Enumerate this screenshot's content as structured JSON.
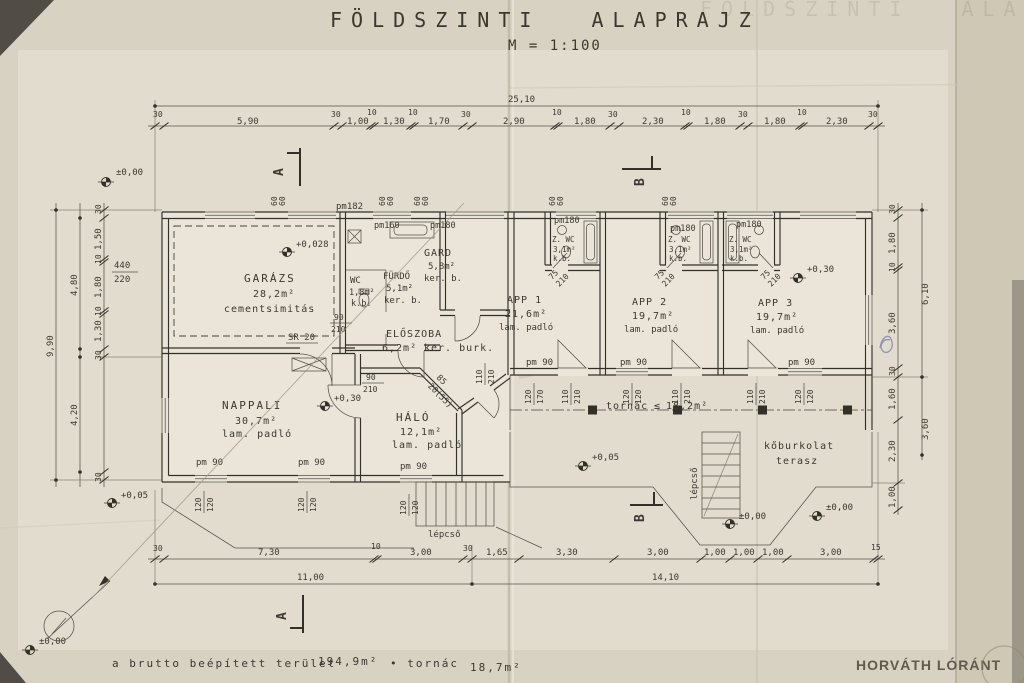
{
  "title": {
    "main": "FÖLDSZINTI ALAPRAJZ",
    "scale": "M = 1:100"
  },
  "sections": {
    "a": "A",
    "b": "B"
  },
  "rooms": {
    "garazs": {
      "name": "GARÁZS",
      "area": "28,2m²",
      "finish": "cementsimitás"
    },
    "nappali": {
      "name": "NAPPALI",
      "area": "30,7m²",
      "finish": "lam. padló"
    },
    "halo": {
      "name": "HÁLÓ",
      "area": "12,1m²",
      "finish": "lam. padló"
    },
    "eloszoba": {
      "name": "ELŐSZOBA",
      "area": "6,2m²",
      "finish": "ker. burk."
    },
    "furdo": {
      "name": "FÜRDŐ",
      "area": "5,1m²",
      "finish": "ker. b."
    },
    "wc": {
      "name": "WC",
      "area": "1,8m²",
      "finish": "k.b."
    },
    "gard": {
      "name": "GARD",
      "area": "5,8m²",
      "finish": "ker. b."
    },
    "app1": {
      "name": "APP 1",
      "area": "21,6m²",
      "finish": "lam. padló"
    },
    "app2": {
      "name": "APP 2",
      "area": "19,7m²",
      "finish": "lam. padló"
    },
    "app3": {
      "name": "APP 3",
      "area": "19,7m²",
      "finish": "lam. padló"
    },
    "zwc": {
      "name": "Z. WC",
      "area": "3,1m²",
      "finish": "k.b."
    },
    "tornac": {
      "name": "tornác",
      "sym": "≤",
      "area": "18,2m²"
    },
    "terasz": {
      "line1": "kőburkolat",
      "line2": "terasz"
    },
    "lepcso": "lépcső"
  },
  "levels": {
    "zero": "±0,00",
    "garage": "+0,028",
    "nappali": "+0,30",
    "app3": "+0,30",
    "entry": "+0,05",
    "left": "+0,05",
    "terrace1": "±0,00",
    "terrace2": "±0,00",
    "corner": "±0,00"
  },
  "openings": {
    "pm182": "pm182",
    "pm160": "pm160",
    "pm180": "pm180",
    "pm90": "pm 90",
    "sill": "60",
    "sr": "SR 20",
    "diag1": "85",
    "diag2": "20(55)"
  },
  "fractions": {
    "f440": [
      "440",
      "220"
    ],
    "f120": [
      "120",
      "120"
    ],
    "f110": [
      "110",
      "210"
    ],
    "f90": [
      "90",
      "210"
    ],
    "f75": [
      "75",
      "210"
    ],
    "f120170": [
      "120",
      "170"
    ]
  },
  "dims": {
    "top": {
      "total": "25,10",
      "segs": [
        "30",
        "5,90",
        "30",
        "1,00",
        "10",
        "1,30",
        "10",
        "1,70",
        "30",
        "2,90",
        "10",
        "1,80",
        "30",
        "2,30",
        "10",
        "1,80",
        "30",
        "1,80",
        "10",
        "2,30",
        "30"
      ]
    },
    "bottom": {
      "segs": [
        "30",
        "7,30",
        "10",
        "3,00",
        "30",
        "1,65",
        "3,30",
        "3,00",
        "1,00",
        "1,00",
        "1,00",
        "3,00",
        "15"
      ],
      "totals": [
        "11,00",
        "14,10"
      ]
    },
    "left": {
      "fine": [
        "30",
        "1,50",
        "10",
        "1,80",
        "10",
        "1,30",
        "30",
        "30"
      ],
      "mid": [
        "4,80",
        "4,20"
      ],
      "total": "9,90"
    },
    "right": {
      "fine": [
        "30",
        "1,80",
        "10",
        "3,60",
        "30",
        "1,60",
        "2,30",
        "1,00"
      ],
      "totals": [
        "6,10",
        "3,60"
      ]
    }
  },
  "footer": {
    "note": "a brutto beépített terület",
    "area": "194,9m²",
    "sep": "• tornác",
    "porch": "18,7m²",
    "signature": "HORVÁTH LÓRÁNT"
  }
}
